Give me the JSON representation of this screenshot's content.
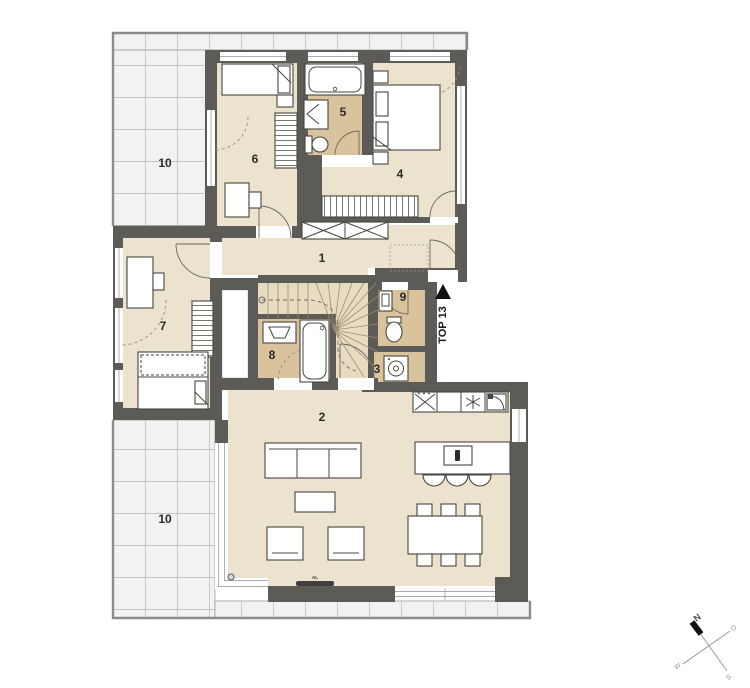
{
  "plan": {
    "unit": {
      "label": "TOP 13"
    },
    "rooms": [
      {
        "num": "1"
      },
      {
        "num": "2"
      },
      {
        "num": "3"
      },
      {
        "num": "4"
      },
      {
        "num": "5"
      },
      {
        "num": "6"
      },
      {
        "num": "7"
      },
      {
        "num": "8"
      },
      {
        "num": "9"
      }
    ],
    "terraces": [
      {
        "num": "10"
      },
      {
        "num": "10"
      }
    ],
    "annotations": {
      "al": "AL"
    },
    "compass": {
      "north": "N",
      "east": "O",
      "south": "S",
      "west": "W"
    },
    "colors": {
      "wall": "#5d5b57",
      "floor": "#ece3cf",
      "wet": "#d9c39c",
      "stair": "#e7dcc1",
      "tile": "#f3f2f0",
      "line": "#474540"
    }
  }
}
